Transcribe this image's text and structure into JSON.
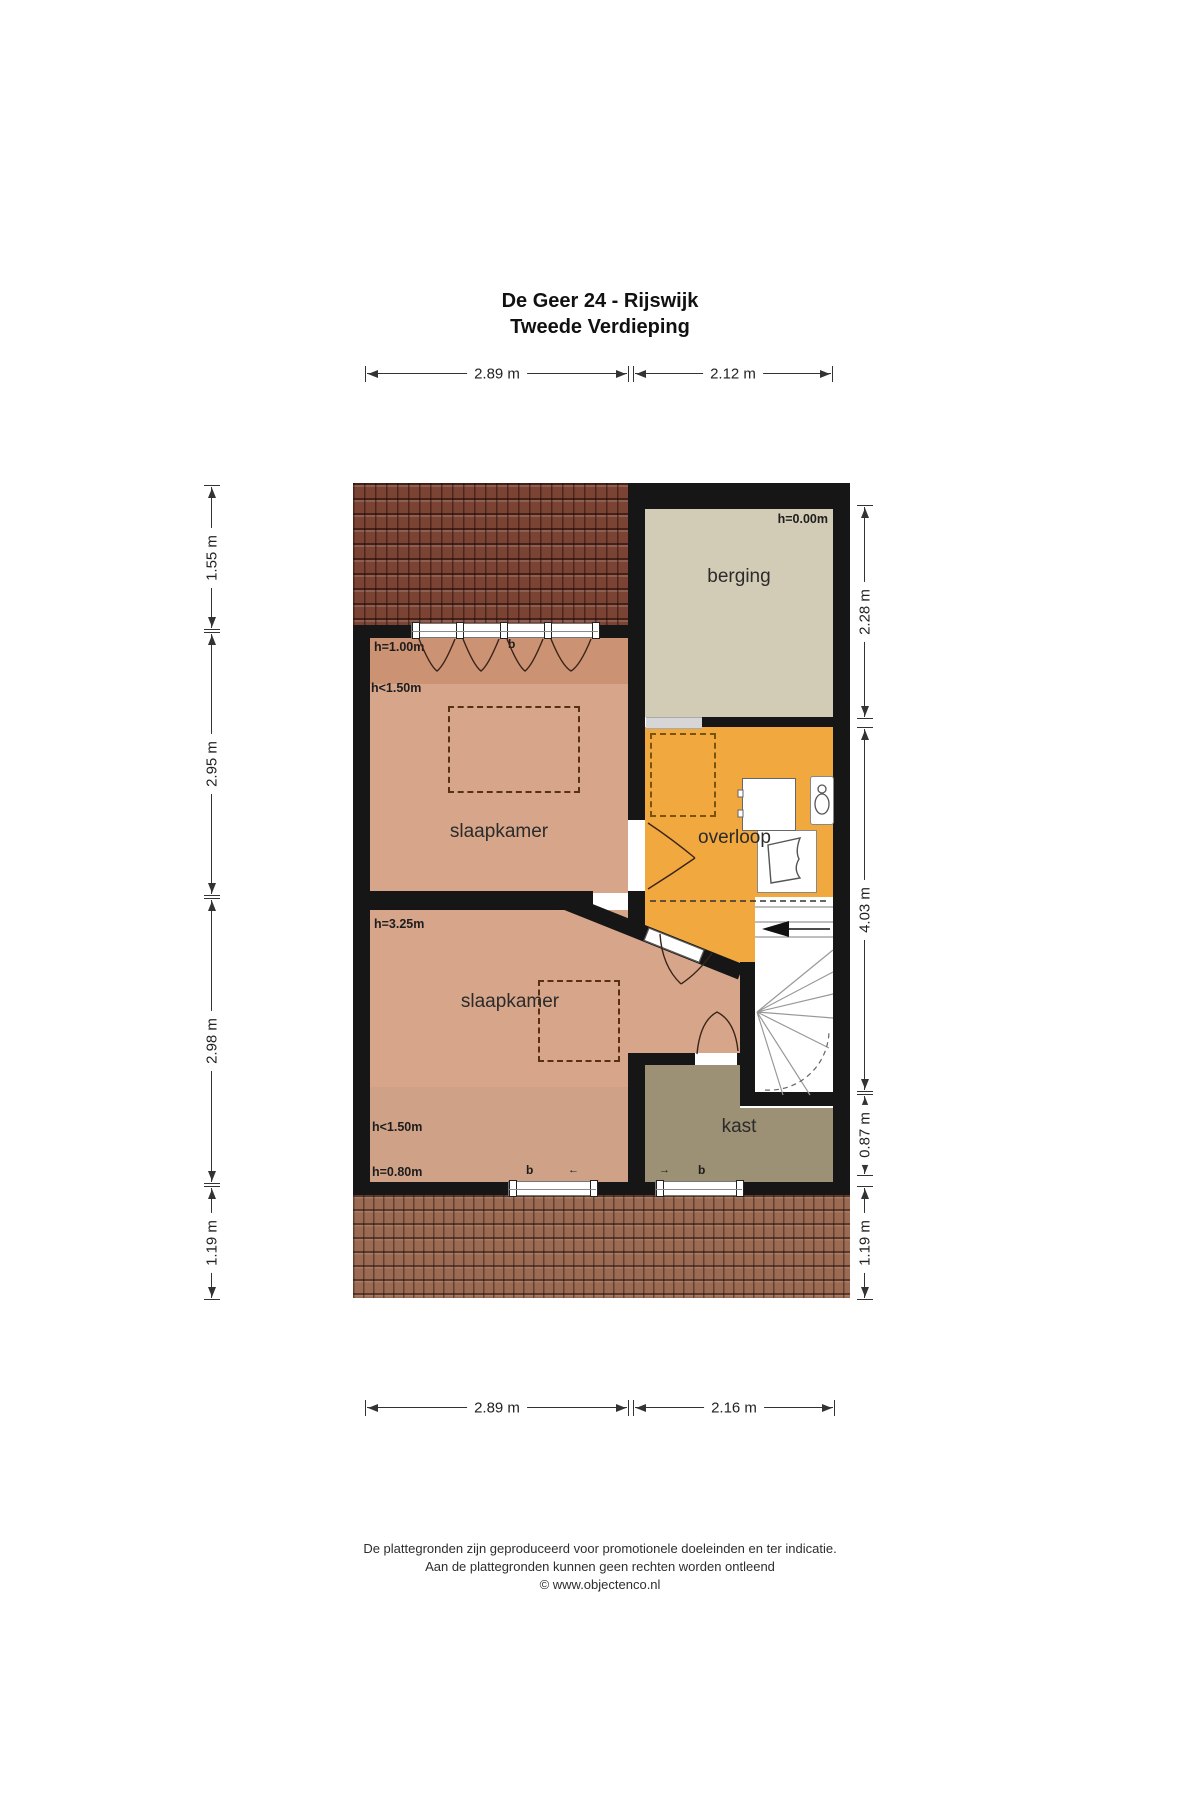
{
  "title": {
    "line1": "De Geer 24 - Rijswijk",
    "line2": "Tweede Verdieping"
  },
  "dimensions": {
    "top": [
      {
        "label": "2.89 m"
      },
      {
        "label": "2.12 m"
      }
    ],
    "bottom": [
      {
        "label": "2.89 m"
      },
      {
        "label": "2.16 m"
      }
    ],
    "left": [
      {
        "label": "1.55 m"
      },
      {
        "label": "2.95 m"
      },
      {
        "label": "2.98 m"
      },
      {
        "label": "1.19 m"
      }
    ],
    "right": [
      {
        "label": "2.28 m"
      },
      {
        "label": "4.03 m"
      },
      {
        "label": "0.87 m"
      },
      {
        "label": "1.19 m"
      }
    ]
  },
  "rooms": {
    "berging": {
      "name": "berging",
      "height_label": "h=0.00m"
    },
    "slaapkamer1": {
      "name": "slaapkamer",
      "height_label_1": "h=1.00m",
      "height_label_2": "h<1.50m"
    },
    "overloop": {
      "name": "overloop"
    },
    "slaapkamer2": {
      "name": "slaapkamer",
      "height_label_1": "h=3.25m",
      "height_label_2": "h<1.50m",
      "height_label_3": "h=0.80m"
    },
    "kast": {
      "name": "kast"
    }
  },
  "window_labels": {
    "top_b": "b",
    "bottom_left_b": "b",
    "bottom_left_arrow": "←",
    "bottom_right_arrow": "→",
    "bottom_right_b": "b"
  },
  "footer": {
    "line1": "De plattegronden zijn geproduceerd voor promotionele doeleinden en ter indicatie.",
    "line2": "Aan de plattegronden kunnen geen rechten worden ontleend",
    "line3": "© www.objectenco.nl"
  },
  "colors": {
    "wall": "#161616",
    "roof_top": "#7b4334",
    "roof_bottom": "#9a6a52",
    "berging_floor": "#d2cbb5",
    "bedroom_light": "#d7a68a",
    "bedroom_dark": "#cb9273",
    "bedroom_lower": "#cfa287",
    "overloop_orange": "#f1a83e",
    "kast_olive": "#9c9075"
  }
}
